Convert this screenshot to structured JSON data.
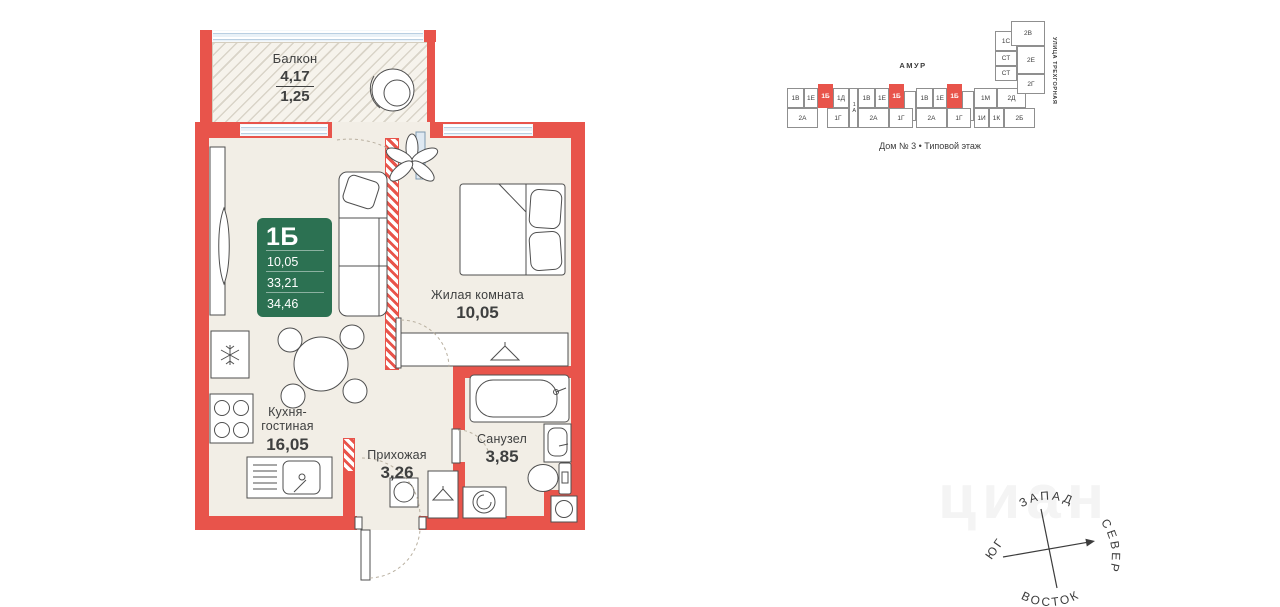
{
  "colors": {
    "wall": "#e8544b",
    "badge": "#2c7152",
    "floor": "#f2eee6",
    "north": "#c9493f"
  },
  "plan": {
    "badge": {
      "type": "1Б",
      "rows": [
        "10,05",
        "33,21",
        "34,46"
      ]
    },
    "balcony": {
      "name": "Балкон",
      "area": "4,17",
      "area_reduced": "1,25"
    },
    "living_room": {
      "name": "Жилая комната",
      "area": "10,05"
    },
    "kitchen": {
      "name_line1": "Кухня-",
      "name_line2": "гостиная",
      "area": "16,05"
    },
    "hallway": {
      "name": "Прихожая",
      "area": "3,26"
    },
    "bathroom": {
      "name": "Санузел",
      "area": "3,85"
    }
  },
  "schematic": {
    "district_label": "АМУР",
    "street_label": "УЛИЦА ТРЕХГОРНАЯ",
    "caption": "Дом № 3 • Типовой этаж",
    "units": [
      {
        "label": "1В",
        "x": 2,
        "y": 73,
        "w": 17,
        "h": 20
      },
      {
        "label": "1Е",
        "x": 19,
        "y": 73,
        "w": 14,
        "h": 20
      },
      {
        "label": "1Б",
        "x": 33,
        "y": 69,
        "w": 15,
        "h": 24,
        "hl": true
      },
      {
        "label": "1Д",
        "x": 48,
        "y": 73,
        "w": 16,
        "h": 20
      },
      {
        "label": "1А",
        "x": 64,
        "y": 73,
        "w": 9,
        "h": 40,
        "v": true
      },
      {
        "label": "1В",
        "x": 73,
        "y": 73,
        "w": 17,
        "h": 20
      },
      {
        "label": "1Е",
        "x": 90,
        "y": 73,
        "w": 14,
        "h": 20
      },
      {
        "label": "1Б",
        "x": 104,
        "y": 69,
        "w": 15,
        "h": 24,
        "hl": true
      },
      {
        "label": "",
        "x": 119,
        "y": 76,
        "w": 12,
        "h": 30
      },
      {
        "label": "1В",
        "x": 131,
        "y": 73,
        "w": 17,
        "h": 20
      },
      {
        "label": "1Е",
        "x": 148,
        "y": 73,
        "w": 14,
        "h": 20
      },
      {
        "label": "1Б",
        "x": 162,
        "y": 69,
        "w": 15,
        "h": 24,
        "hl": true
      },
      {
        "label": "",
        "x": 177,
        "y": 76,
        "w": 12,
        "h": 30
      },
      {
        "label": "1М",
        "x": 189,
        "y": 73,
        "w": 23,
        "h": 20
      },
      {
        "label": "2Д",
        "x": 212,
        "y": 73,
        "w": 29,
        "h": 20
      },
      {
        "label": "2А",
        "x": 2,
        "y": 93,
        "w": 31,
        "h": 20
      },
      {
        "label": "1Г",
        "x": 42,
        "y": 93,
        "w": 22,
        "h": 20
      },
      {
        "label": "2А",
        "x": 73,
        "y": 93,
        "w": 31,
        "h": 20
      },
      {
        "label": "1Г",
        "x": 104,
        "y": 93,
        "w": 24,
        "h": 20
      },
      {
        "label": "2А",
        "x": 131,
        "y": 93,
        "w": 31,
        "h": 20
      },
      {
        "label": "1Г",
        "x": 162,
        "y": 93,
        "w": 24,
        "h": 20
      },
      {
        "label": "1И",
        "x": 189,
        "y": 93,
        "w": 15,
        "h": 20
      },
      {
        "label": "1К",
        "x": 204,
        "y": 93,
        "w": 15,
        "h": 20
      },
      {
        "label": "2Б",
        "x": 219,
        "y": 93,
        "w": 31,
        "h": 20
      },
      {
        "label": "1С",
        "x": 210,
        "y": 16,
        "w": 22,
        "h": 20
      },
      {
        "label": "СТ",
        "x": 210,
        "y": 36,
        "w": 22,
        "h": 15
      },
      {
        "label": "СТ",
        "x": 210,
        "y": 51,
        "w": 22,
        "h": 15
      },
      {
        "label": "2В",
        "x": 226,
        "y": 6,
        "w": 34,
        "h": 25
      },
      {
        "label": "2Е",
        "x": 232,
        "y": 31,
        "w": 28,
        "h": 28
      },
      {
        "label": "2Г",
        "x": 232,
        "y": 59,
        "w": 28,
        "h": 20
      }
    ]
  },
  "compass": {
    "west": "ЗАПАД",
    "north": "СЕВЕР",
    "east": "ВОСТОК",
    "south": "ЮГ"
  },
  "watermark": "циан"
}
